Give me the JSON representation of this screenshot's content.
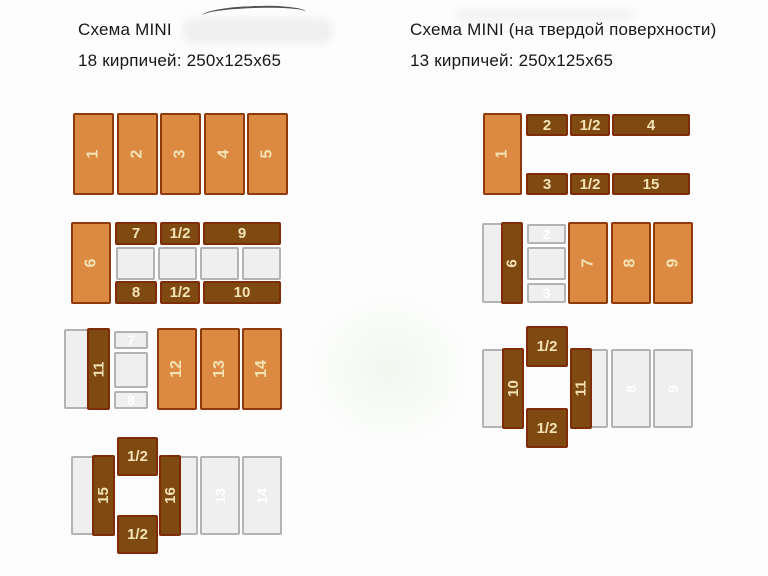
{
  "titles": {
    "left": {
      "line1": "Схема MINI",
      "line2": "18 кирпичей: 250x125x65"
    },
    "right": {
      "line1": "Схема MINI (на твердой поверхности)",
      "line2": "13 кирпичей: 250x125x65"
    }
  },
  "colors": {
    "brick_orange": "#DC8A42",
    "brick_orange_border": "#8E3A0C",
    "brick_brown": "#7E4A11",
    "brick_brown_border": "#7E2B07",
    "ghost_fill": "#EFEFEF",
    "ghost_border": "#B3B3B3",
    "label_cream": "#F3E3B4",
    "background": "#FDFDFD"
  },
  "diagram": {
    "schemes": [
      {
        "id": "left",
        "bricks": [
          {
            "label": "1",
            "type": "orange",
            "o": "v",
            "x": 73,
            "y": 113,
            "w": 41,
            "h": 82
          },
          {
            "label": "2",
            "type": "orange",
            "o": "v",
            "x": 116.5,
            "y": 113,
            "w": 41,
            "h": 82
          },
          {
            "label": "3",
            "type": "orange",
            "o": "v",
            "x": 160,
            "y": 113,
            "w": 41,
            "h": 82
          },
          {
            "label": "4",
            "type": "orange",
            "o": "v",
            "x": 203.5,
            "y": 113,
            "w": 41,
            "h": 82
          },
          {
            "label": "5",
            "type": "orange",
            "o": "v",
            "x": 247,
            "y": 113,
            "w": 41,
            "h": 82
          },
          {
            "label": "",
            "type": "ghost",
            "o": "v",
            "x": 116,
            "y": 247,
            "w": 39,
            "h": 33
          },
          {
            "label": "",
            "type": "ghost",
            "o": "v",
            "x": 158,
            "y": 247,
            "w": 39,
            "h": 33
          },
          {
            "label": "",
            "type": "ghost",
            "o": "v",
            "x": 200,
            "y": 247,
            "w": 39,
            "h": 33
          },
          {
            "label": "",
            "type": "ghost",
            "o": "v",
            "x": 242,
            "y": 247,
            "w": 39,
            "h": 33
          },
          {
            "label": "6",
            "type": "orange",
            "o": "v",
            "x": 71,
            "y": 222,
            "w": 40,
            "h": 82
          },
          {
            "label": "7",
            "type": "brown",
            "o": "h",
            "x": 115,
            "y": 222,
            "w": 42,
            "h": 23
          },
          {
            "label": "1/2",
            "type": "brown",
            "o": "h",
            "x": 160,
            "y": 222,
            "w": 40,
            "h": 23
          },
          {
            "label": "9",
            "type": "brown",
            "o": "h",
            "x": 203,
            "y": 222,
            "w": 78,
            "h": 23
          },
          {
            "label": "8",
            "type": "brown",
            "o": "h",
            "x": 115,
            "y": 281,
            "w": 42,
            "h": 23
          },
          {
            "label": "1/2",
            "type": "brown",
            "o": "h",
            "x": 160,
            "y": 281,
            "w": 40,
            "h": 23
          },
          {
            "label": "10",
            "type": "brown",
            "o": "h",
            "x": 203,
            "y": 281,
            "w": 78,
            "h": 23
          },
          {
            "label": "",
            "type": "ghost",
            "o": "v",
            "x": 64,
            "y": 329,
            "w": 41,
            "h": 80
          },
          {
            "label": "7",
            "type": "ghost",
            "o": "h",
            "x": 114,
            "y": 331,
            "w": 34,
            "h": 18
          },
          {
            "label": "",
            "type": "ghost",
            "o": "h",
            "x": 114,
            "y": 352,
            "w": 34,
            "h": 36
          },
          {
            "label": "8",
            "type": "ghost",
            "o": "h",
            "x": 114,
            "y": 391,
            "w": 34,
            "h": 18
          },
          {
            "label": "11",
            "type": "brown",
            "o": "v",
            "x": 87,
            "y": 328,
            "w": 23,
            "h": 82
          },
          {
            "label": "12",
            "type": "orange",
            "o": "v",
            "x": 157,
            "y": 328,
            "w": 40,
            "h": 82
          },
          {
            "label": "13",
            "type": "orange",
            "o": "v",
            "x": 199.5,
            "y": 328,
            "w": 40,
            "h": 82
          },
          {
            "label": "14",
            "type": "orange",
            "o": "v",
            "x": 242,
            "y": 328,
            "w": 40,
            "h": 82
          },
          {
            "label": "",
            "type": "ghost",
            "o": "v",
            "x": 71,
            "y": 456,
            "w": 40,
            "h": 79
          },
          {
            "label": "",
            "type": "ghost",
            "o": "v",
            "x": 162,
            "y": 456,
            "w": 36,
            "h": 79
          },
          {
            "label": "13",
            "type": "ghost",
            "o": "v",
            "x": 200,
            "y": 456,
            "w": 40,
            "h": 79
          },
          {
            "label": "14",
            "type": "ghost",
            "o": "v",
            "x": 242,
            "y": 456,
            "w": 40,
            "h": 79
          },
          {
            "label": "15",
            "type": "brown",
            "o": "v",
            "x": 92,
            "y": 455,
            "w": 23,
            "h": 81
          },
          {
            "label": "16",
            "type": "brown",
            "o": "v",
            "x": 159,
            "y": 455,
            "w": 22,
            "h": 81
          },
          {
            "label": "1/2",
            "type": "brown",
            "o": "h",
            "x": 117,
            "y": 437,
            "w": 41,
            "h": 39
          },
          {
            "label": "1/2",
            "type": "brown",
            "o": "h",
            "x": 117,
            "y": 515,
            "w": 41,
            "h": 39
          }
        ]
      },
      {
        "id": "right",
        "bricks": [
          {
            "label": "1",
            "type": "orange",
            "o": "v",
            "x": 483,
            "y": 113,
            "w": 39,
            "h": 82
          },
          {
            "label": "2",
            "type": "brown",
            "o": "h",
            "x": 526,
            "y": 114,
            "w": 42,
            "h": 22
          },
          {
            "label": "1/2",
            "type": "brown",
            "o": "h",
            "x": 570,
            "y": 114,
            "w": 40,
            "h": 22
          },
          {
            "label": "4",
            "type": "brown",
            "o": "h",
            "x": 612,
            "y": 114,
            "w": 78,
            "h": 22
          },
          {
            "label": "3",
            "type": "brown",
            "o": "h",
            "x": 526,
            "y": 173,
            "w": 42,
            "h": 22
          },
          {
            "label": "1/2",
            "type": "brown",
            "o": "h",
            "x": 570,
            "y": 173,
            "w": 40,
            "h": 22
          },
          {
            "label": "15",
            "type": "brown",
            "o": "h",
            "x": 612,
            "y": 173,
            "w": 78,
            "h": 22
          },
          {
            "label": "",
            "type": "ghost",
            "o": "v",
            "x": 482,
            "y": 223,
            "w": 40,
            "h": 80
          },
          {
            "label": "2",
            "type": "ghost",
            "o": "h",
            "x": 527,
            "y": 224,
            "w": 39,
            "h": 20
          },
          {
            "label": "",
            "type": "ghost",
            "o": "h",
            "x": 527,
            "y": 247,
            "w": 39,
            "h": 33
          },
          {
            "label": "3",
            "type": "ghost",
            "o": "h",
            "x": 527,
            "y": 283,
            "w": 39,
            "h": 20
          },
          {
            "label": "6",
            "type": "brown",
            "o": "v",
            "x": 501,
            "y": 222,
            "w": 22,
            "h": 82
          },
          {
            "label": "7",
            "type": "orange",
            "o": "v",
            "x": 568,
            "y": 222,
            "w": 40,
            "h": 82
          },
          {
            "label": "8",
            "type": "orange",
            "o": "v",
            "x": 610.5,
            "y": 222,
            "w": 40,
            "h": 82
          },
          {
            "label": "9",
            "type": "orange",
            "o": "v",
            "x": 653,
            "y": 222,
            "w": 40,
            "h": 82
          },
          {
            "label": "",
            "type": "ghost",
            "o": "v",
            "x": 482,
            "y": 349,
            "w": 40,
            "h": 79
          },
          {
            "label": "",
            "type": "ghost",
            "o": "v",
            "x": 572,
            "y": 349,
            "w": 36,
            "h": 79
          },
          {
            "label": "8",
            "type": "ghost",
            "o": "v",
            "x": 610.5,
            "y": 349,
            "w": 40,
            "h": 79
          },
          {
            "label": "9",
            "type": "ghost",
            "o": "v",
            "x": 653,
            "y": 349,
            "w": 40,
            "h": 79
          },
          {
            "label": "10",
            "type": "brown",
            "o": "v",
            "x": 502,
            "y": 348,
            "w": 22,
            "h": 81
          },
          {
            "label": "11",
            "type": "brown",
            "o": "v",
            "x": 570,
            "y": 348,
            "w": 22,
            "h": 81
          },
          {
            "label": "1/2",
            "type": "brown",
            "o": "h",
            "x": 526,
            "y": 326,
            "w": 42,
            "h": 41
          },
          {
            "label": "1/2",
            "type": "brown",
            "o": "h",
            "x": 526,
            "y": 408,
            "w": 42,
            "h": 40
          }
        ]
      }
    ]
  }
}
